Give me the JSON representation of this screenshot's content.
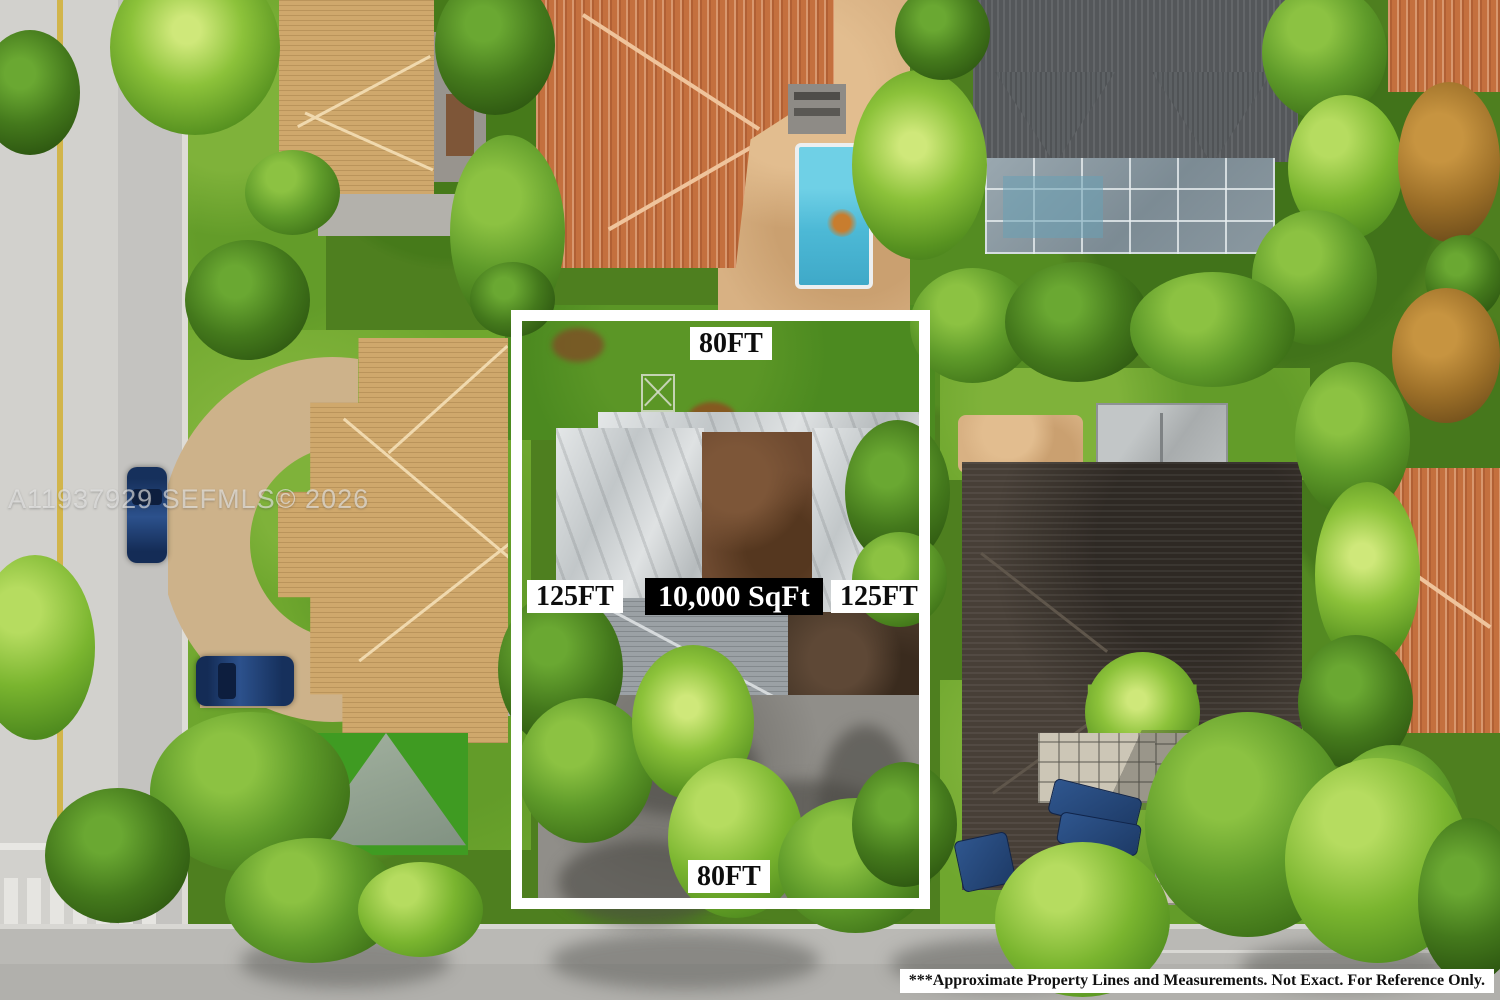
{
  "image": {
    "kind": "aerial-drone-real-estate-photo",
    "watermark_text": "A11937929 SEFMLS© 2026",
    "disclaimer_text": "***Approximate Property Lines and Measurements. Not Exact. For Reference Only."
  },
  "boundary_overlay": {
    "top_label": "80FT",
    "bottom_label": "80FT",
    "left_label": "125FT",
    "right_label": "125FT",
    "area_label": "10,000 SqFt",
    "line_color": "#ffffff",
    "dim_label_bg": "#ffffff",
    "dim_label_text": "#0d0d0d",
    "area_label_bg": "#000000",
    "area_label_text": "#ffffff"
  },
  "scene_palette": {
    "grass": "#6fa72e",
    "dense_trees": "#3f7318",
    "road_asphalt": "#c4c3c0",
    "road_yellow_line": "#d2b54b",
    "pool_water": "#4db9d6",
    "terracotta_roof": "#c4703e",
    "tan_roof": "#cfa86c",
    "dark_shingle_roof": "#54575a",
    "dark_brown_roof": "#473f37",
    "tarp_roof_white": "#d6d9da",
    "sand_patio": "#d8b183"
  }
}
